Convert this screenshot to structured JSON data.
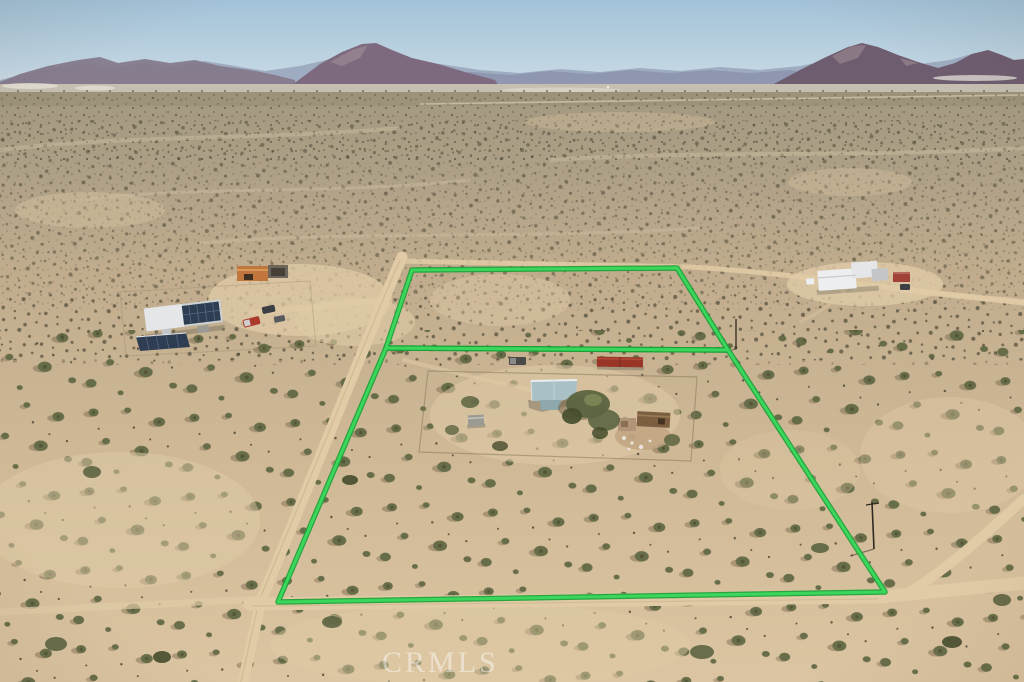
{
  "image": {
    "type": "aerial-drone-photograph",
    "description": "Aerial view of a desert property: two adjoining parcels outlined in bright green, the larger lower parcel containing a fenced homestead with a light-blue-roofed house, red shipping container, shed and debris; neighboring homes to the west and northeast; dirt roads bordering the parcels; scrub desert stretching to distant mountain ranges under a hazy blue sky.",
    "watermark": "CRMLS"
  },
  "features": {
    "upper_parcel": "vacant land parcel outlined in green",
    "lower_parcel": "main parcel outlined in green containing homestead",
    "main_house": "house with light blue-gray roof",
    "shipping_container": "red shipping container",
    "shed": "small gray shed",
    "debris_cluster": "outbuildings and debris east of house",
    "yard_fence": "fenced yard around homestead",
    "west_neighbor": "neighboring home with rooftop and ground solar panels",
    "northeast_neighbor": "neighboring white home with red-roof shed",
    "utility_poles": "utility poles with shadows",
    "dirt_roads": "dirt roads along west, south and east boundaries",
    "mountains": "distant desert mountain ranges",
    "sky": "hazy blue sky"
  },
  "colors": {
    "sky_top": "#a2c2d8",
    "sky_horizon": "#cddce6",
    "haze_ridge": "#98a4bb",
    "ridge_left": "#84788b",
    "mountain_center": "#7d6a7e",
    "mountain_right": "#6e5d6f",
    "mountain_highlight": "#a28e97",
    "ridge_mid": "#8b92ab",
    "basin": "#c6beb0",
    "playa_white": "#e6e2d8",
    "desert_far": "#a39880",
    "desert_mid": "#c0ac8d",
    "desert_near": "#d6bf9c",
    "desert_bottom": "#dcc5a2",
    "dark_strip": "#968b73",
    "speck_dark": "#4f4a38",
    "shrub_green": "#5c6440",
    "shrub_dark": "#454c2c",
    "shrub_shadow": "#6b5b41",
    "sand_light": "#e0cba7",
    "road": "#e0cba6",
    "road_center": "#c9b28c",
    "boundary_green": "#3bd75c",
    "boundary_green_dark": "#17a035",
    "fence": "#8a7a5f",
    "roof_main": "#a9c1c6",
    "roof_main_dark": "#8fa8ae",
    "roof_ridge_white": "#e9eef0",
    "house_shadow": "#75705f",
    "shed_gray": "#9b9b93",
    "container_red": "#993527",
    "container_red_light": "#b0493a",
    "debris_brown": "#7c5f41",
    "debris_tan": "#b09579",
    "debris_white": "#e9e4da",
    "vehicle_dark": "#4a4a4a",
    "truck_red": "#ab3a2c",
    "suv_dark": "#3c4045",
    "neighbor_roof": "#cdd1d4",
    "neighbor_white": "#e4e6e8",
    "solar_dark": "#2e3d52",
    "solar_line": "#57697f",
    "orange_building": "#c0763d",
    "orange_roof": "#d99a56",
    "carport_gray": "#6e655a",
    "ne_white": "#eceeef",
    "ne_gray": "#c2c6c9",
    "red_roof": "#a04238",
    "pole_dark": "#2f2a22",
    "dirt_patch": "#c0a37f",
    "watermark_color": "#ffffff"
  }
}
